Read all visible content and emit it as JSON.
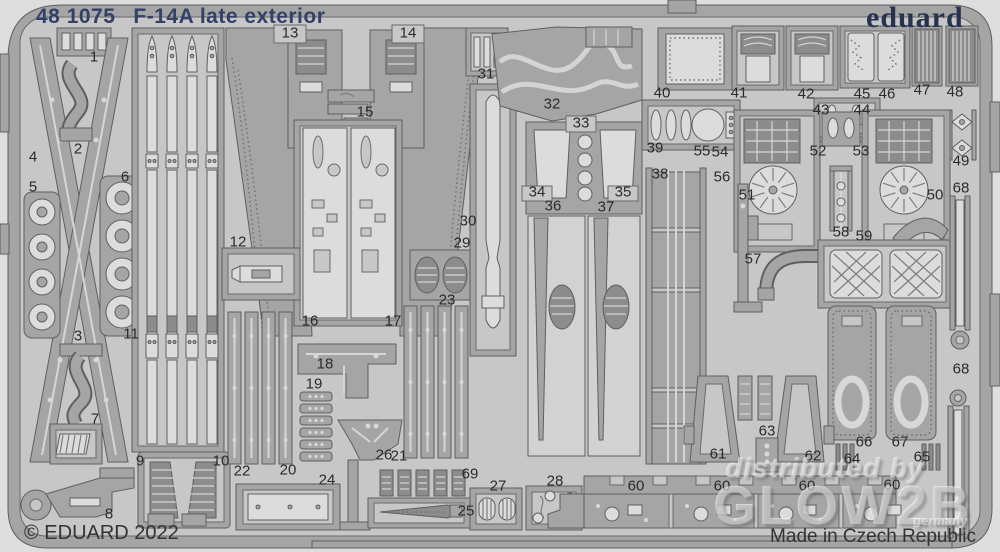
{
  "header": {
    "catalog_number": "48 1075",
    "product_name": "F-14A late exterior",
    "brand_logo": "eduard"
  },
  "footer": {
    "copyright": "© EDUARD 2022",
    "made_in": "Made in Czech Republic"
  },
  "watermark": {
    "line1": "distributed by",
    "line2": "GLOW2B",
    "line3": "germany"
  },
  "colors": {
    "title": "#334067",
    "logo": "#27324e",
    "text": "#333333",
    "label": "#2b2b2b",
    "background": "#dedede",
    "plate": "#a5a5a5",
    "field": "#c7c7c7",
    "part_light": "#dcdcdc",
    "part_dark": "#8c8c8c"
  },
  "part_labels": [
    {
      "n": "1",
      "x": 94,
      "y": 58
    },
    {
      "n": "2",
      "x": 78,
      "y": 150
    },
    {
      "n": "3",
      "x": 78,
      "y": 337
    },
    {
      "n": "4",
      "x": 33,
      "y": 158
    },
    {
      "n": "5",
      "x": 33,
      "y": 188
    },
    {
      "n": "6",
      "x": 125,
      "y": 178
    },
    {
      "n": "7",
      "x": 95,
      "y": 420
    },
    {
      "n": "8",
      "x": 109,
      "y": 515
    },
    {
      "n": "9",
      "x": 140,
      "y": 462
    },
    {
      "n": "10",
      "x": 221,
      "y": 462
    },
    {
      "n": "11",
      "x": 131,
      "y": 335
    },
    {
      "n": "12",
      "x": 238,
      "y": 243
    },
    {
      "n": "13",
      "x": 290,
      "y": 34
    },
    {
      "n": "14",
      "x": 408,
      "y": 34
    },
    {
      "n": "15",
      "x": 365,
      "y": 113
    },
    {
      "n": "16",
      "x": 310,
      "y": 322
    },
    {
      "n": "17",
      "x": 393,
      "y": 322
    },
    {
      "n": "18",
      "x": 325,
      "y": 365
    },
    {
      "n": "19",
      "x": 314,
      "y": 385
    },
    {
      "n": "20",
      "x": 288,
      "y": 471
    },
    {
      "n": "21",
      "x": 399,
      "y": 457
    },
    {
      "n": "22",
      "x": 242,
      "y": 472
    },
    {
      "n": "23",
      "x": 447,
      "y": 301
    },
    {
      "n": "24",
      "x": 327,
      "y": 481
    },
    {
      "n": "25",
      "x": 466,
      "y": 512
    },
    {
      "n": "26",
      "x": 384,
      "y": 456
    },
    {
      "n": "27",
      "x": 498,
      "y": 487
    },
    {
      "n": "28",
      "x": 555,
      "y": 482
    },
    {
      "n": "29",
      "x": 462,
      "y": 244
    },
    {
      "n": "30",
      "x": 468,
      "y": 222
    },
    {
      "n": "31",
      "x": 486,
      "y": 75
    },
    {
      "n": "32",
      "x": 552,
      "y": 105
    },
    {
      "n": "33",
      "x": 581,
      "y": 124
    },
    {
      "n": "34",
      "x": 537,
      "y": 193
    },
    {
      "n": "35",
      "x": 623,
      "y": 193
    },
    {
      "n": "36",
      "x": 553,
      "y": 207
    },
    {
      "n": "37",
      "x": 606,
      "y": 208
    },
    {
      "n": "38",
      "x": 660,
      "y": 175
    },
    {
      "n": "39",
      "x": 655,
      "y": 149
    },
    {
      "n": "40",
      "x": 662,
      "y": 94
    },
    {
      "n": "41",
      "x": 739,
      "y": 94
    },
    {
      "n": "42",
      "x": 806,
      "y": 95
    },
    {
      "n": "43",
      "x": 821,
      "y": 111
    },
    {
      "n": "44",
      "x": 862,
      "y": 111
    },
    {
      "n": "45",
      "x": 862,
      "y": 95
    },
    {
      "n": "46",
      "x": 887,
      "y": 95
    },
    {
      "n": "47",
      "x": 922,
      "y": 91
    },
    {
      "n": "48",
      "x": 955,
      "y": 93
    },
    {
      "n": "49",
      "x": 961,
      "y": 162
    },
    {
      "n": "50",
      "x": 935,
      "y": 196
    },
    {
      "n": "51",
      "x": 747,
      "y": 196
    },
    {
      "n": "52",
      "x": 818,
      "y": 152
    },
    {
      "n": "53",
      "x": 861,
      "y": 152
    },
    {
      "n": "54",
      "x": 720,
      "y": 153
    },
    {
      "n": "55",
      "x": 702,
      "y": 152
    },
    {
      "n": "56",
      "x": 722,
      "y": 178
    },
    {
      "n": "57",
      "x": 753,
      "y": 260
    },
    {
      "n": "58",
      "x": 841,
      "y": 233
    },
    {
      "n": "59",
      "x": 864,
      "y": 237
    },
    {
      "n": "60",
      "x": 636,
      "y": 487
    },
    {
      "n": "60",
      "x": 722,
      "y": 487
    },
    {
      "n": "60",
      "x": 807,
      "y": 487
    },
    {
      "n": "60",
      "x": 892,
      "y": 486
    },
    {
      "n": "61",
      "x": 718,
      "y": 455
    },
    {
      "n": "62",
      "x": 813,
      "y": 457
    },
    {
      "n": "63",
      "x": 767,
      "y": 432
    },
    {
      "n": "64",
      "x": 852,
      "y": 460
    },
    {
      "n": "65",
      "x": 922,
      "y": 458
    },
    {
      "n": "66",
      "x": 864,
      "y": 443
    },
    {
      "n": "67",
      "x": 900,
      "y": 443
    },
    {
      "n": "68",
      "x": 961,
      "y": 189
    },
    {
      "n": "68",
      "x": 961,
      "y": 370
    },
    {
      "n": "69",
      "x": 470,
      "y": 475
    }
  ]
}
